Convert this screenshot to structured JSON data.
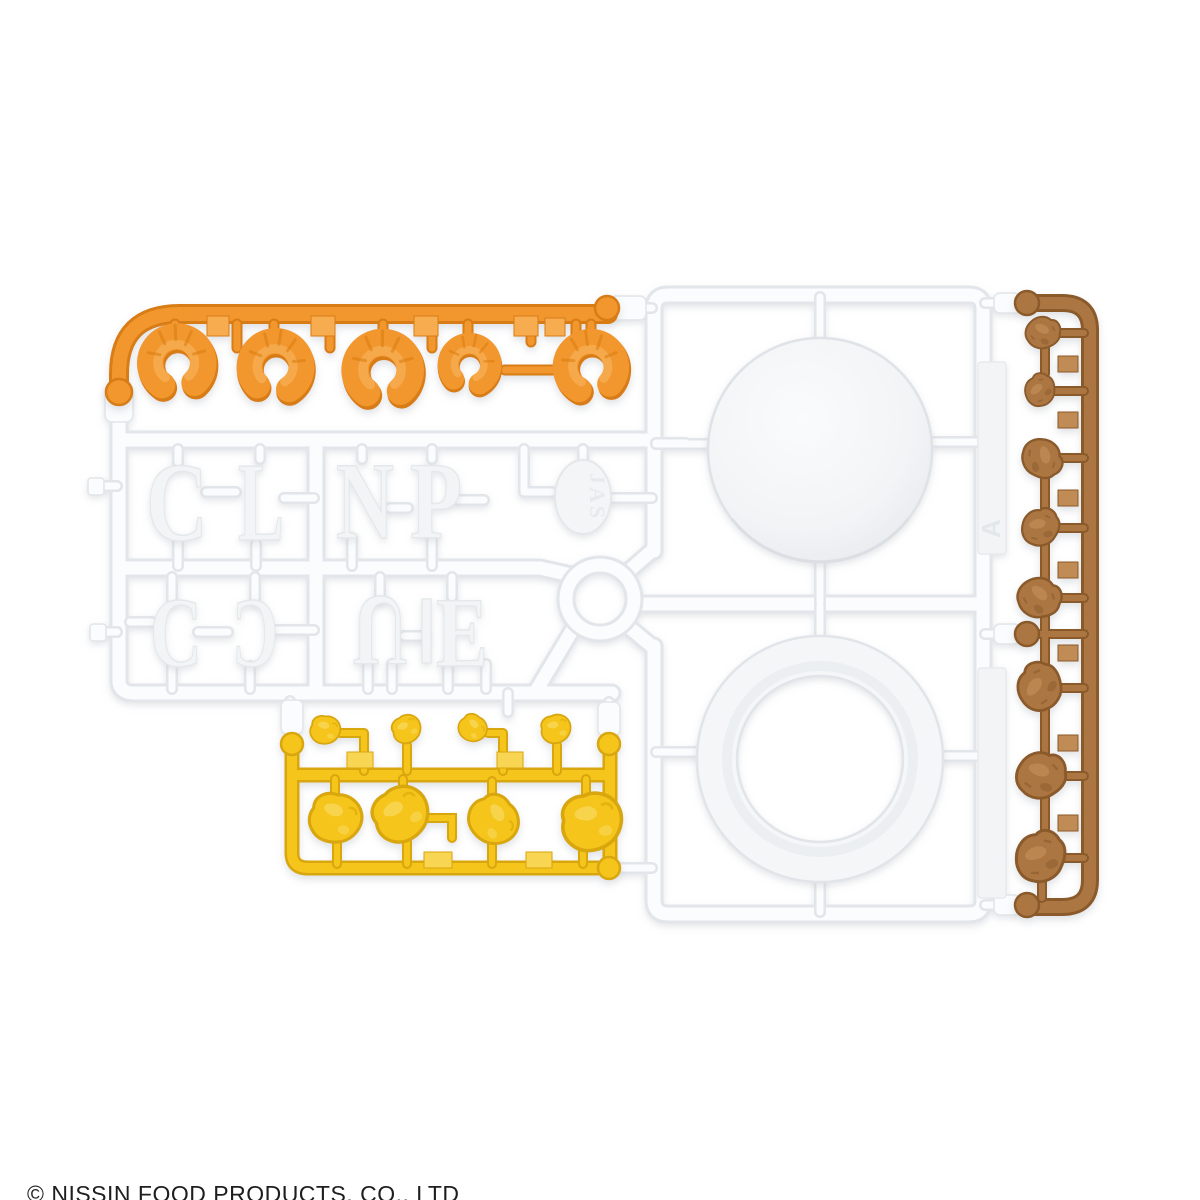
{
  "footer": {
    "copyright": "© NISSIN FOOD PRODUCTS, CO., LTD"
  },
  "colors": {
    "background": "#FFFFFF",
    "white": "#FBFCFD",
    "white_edge": "#E2E5E9",
    "white_deep": "#D8DCE0",
    "letter_fill": "#F2F4F6",
    "letter_edge": "#E4E8EB",
    "orange": "#F2972E",
    "orange_dark": "#D87C12",
    "orange_light": "#F6AC50",
    "yellow": "#F6C51D",
    "yellow_dark": "#D8A60A",
    "yellow_light": "#F8D553",
    "brown": "#AC7642",
    "brown_dark": "#8A5A2B",
    "brown_light": "#C08B55",
    "text": "#1E1E1E"
  },
  "sprue": {
    "jas_mark": "JAS",
    "runner_tag": "A",
    "letter_parts": {
      "row1": [
        "C",
        "L",
        "N",
        "P"
      ],
      "row2": [
        "C",
        "C",
        "U",
        "E"
      ]
    },
    "part_counts": {
      "shrimp": 5,
      "egg": 8,
      "meat": 8,
      "lid_disc": 1,
      "cup_ring": 1
    }
  }
}
